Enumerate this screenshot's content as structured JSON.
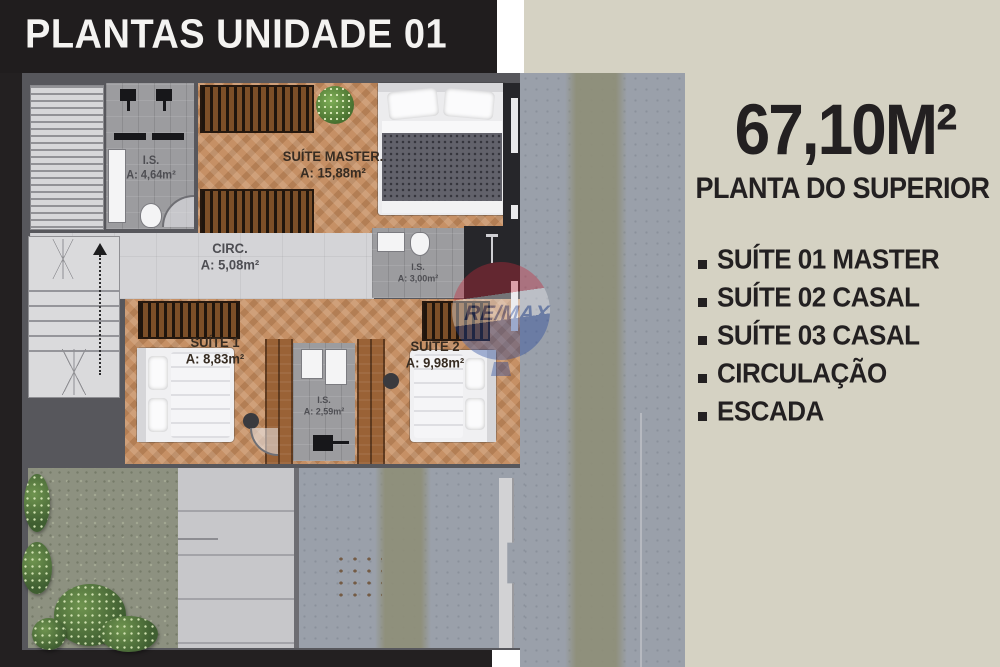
{
  "banner": {
    "title": "PLANTAS UNIDADE 01"
  },
  "info_panel": {
    "area": "67,10M²",
    "subtitle": "PLANTA DO SUPERIOR",
    "legend": [
      "SUÍTE 01  MASTER",
      "SUÍTE 02 CASAL",
      "SUÍTE 03  CASAL",
      "CIRCULAÇÃO",
      "ESCADA"
    ]
  },
  "floor_plan": {
    "rooms": [
      {
        "name": "I.S.",
        "area": "A: 4,64m²"
      },
      {
        "name": "SUÍTE MASTER.",
        "area": "A: 15,88m²"
      },
      {
        "name": "CIRC.",
        "area": "A: 5,08m²"
      },
      {
        "name": "I.S.",
        "area": "A: 3,00m²"
      },
      {
        "name": "SUÍTE 1",
        "area": "A: 8,83m²"
      },
      {
        "name": "I.S.",
        "area": "A: 2,59m²"
      },
      {
        "name": "SUÍTE 2",
        "area": "A: 9,98m²"
      }
    ],
    "watermark": "RE/MAX"
  },
  "colors": {
    "background_cream": "#d5d2c3",
    "banner_black": "#201d1e",
    "wood_floor": "#c69065",
    "wall_gray": "#57575c",
    "concrete_gray": "#9aa0aa",
    "watermark_red": "#c6293a",
    "watermark_blue": "#20449c"
  }
}
